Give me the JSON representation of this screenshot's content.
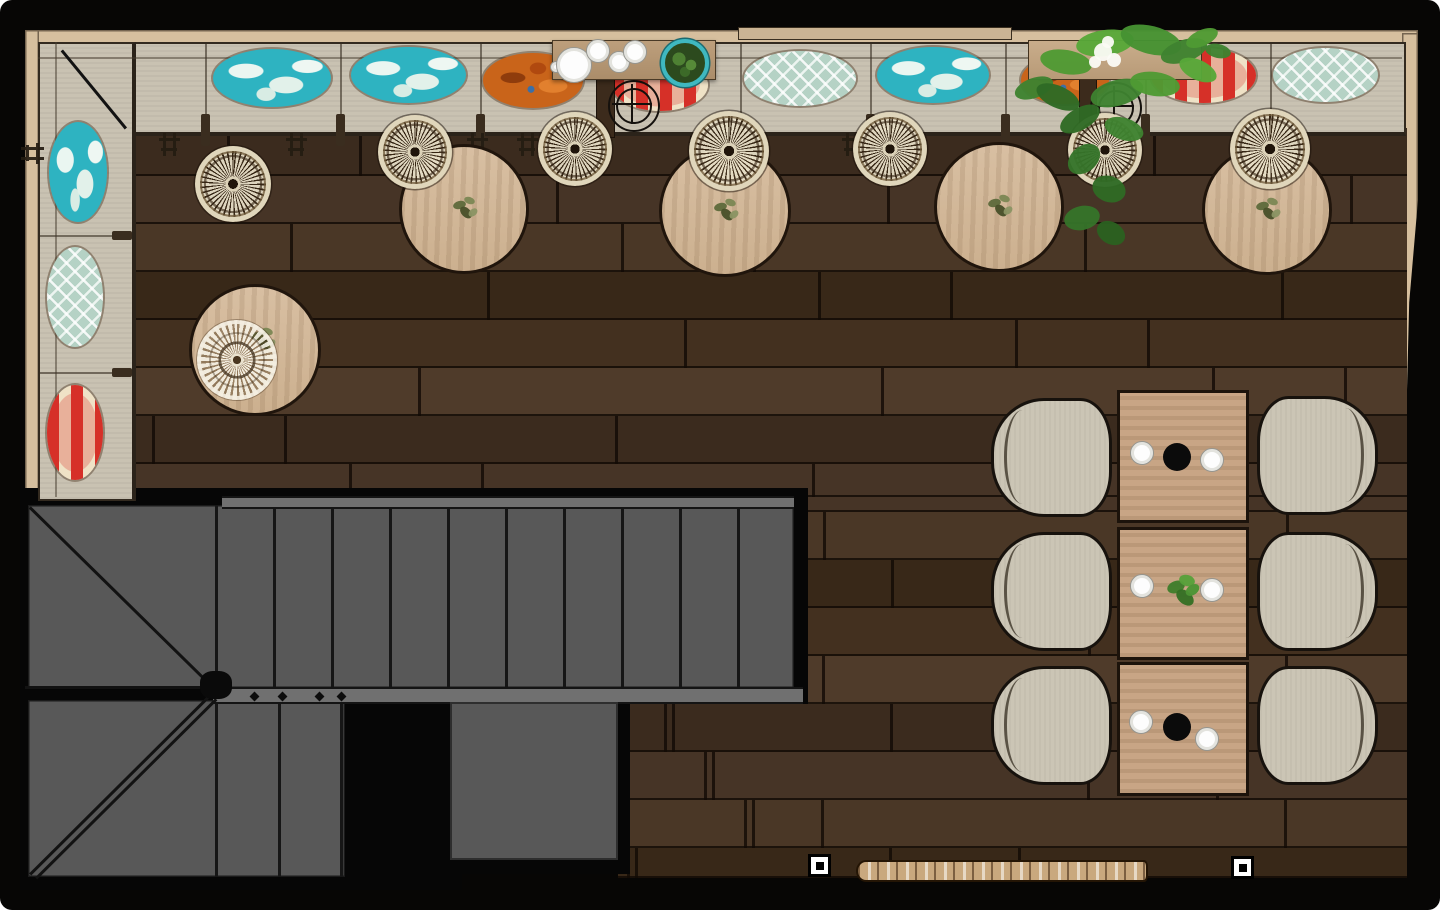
{
  "colors": {
    "wall_black": "#070605",
    "wood_trim": "#d6bf9e",
    "bench_fill": "#c9c2b2",
    "floor_planks": [
      "#463426",
      "#3b2b1e",
      "#4f3b2a",
      "#43301f",
      "#382818",
      "#4a3726"
    ],
    "stair_gray": "#585858",
    "table_wood": "#d3b698",
    "dining_table_wood": "#c8a585",
    "chair_fill": "#cbc5b5",
    "pillow_turquoise": "#2eb3c1",
    "pillow_seafoam": "#b5d2c5",
    "pillow_orange": "#c9641a",
    "pillow_red": "#d63028",
    "plant_green": "#3e8230",
    "pot_teal": "#3fb8c0"
  },
  "structure": {
    "trims": [
      {
        "x": 27,
        "y": 30,
        "w": 1391,
        "h": 16,
        "kind": "trim"
      },
      {
        "x": 25,
        "y": 30,
        "w": 14,
        "h": 462,
        "kind": "trim"
      },
      {
        "x": 1402,
        "y": 33,
        "w": 16,
        "h": 460,
        "kind": "trim"
      },
      {
        "x": 738,
        "y": 27,
        "w": 272,
        "h": 11,
        "kind": "ledge"
      }
    ],
    "right_wall_shadow": {
      "x": 1402,
      "y": 200,
      "w": 16,
      "h": 293
    }
  },
  "floor": {
    "origin_y": 128,
    "row_h": 48,
    "rects": [
      {
        "x": 130,
        "y": 128,
        "w": 1277,
        "h": 369
      },
      {
        "x": 795,
        "y": 497,
        "w": 612,
        "h": 381
      },
      {
        "x": 618,
        "y": 700,
        "w": 177,
        "h": 178
      }
    ]
  },
  "stairs": {
    "blacks": [
      {
        "x": 20,
        "y": 488,
        "w": 788,
        "h": 216
      },
      {
        "x": 20,
        "y": 700,
        "w": 442,
        "h": 190
      },
      {
        "x": 438,
        "y": 690,
        "w": 192,
        "h": 184
      }
    ],
    "flight_upper": {
      "x": 28,
      "y": 505,
      "w": 766,
      "h": 183,
      "treads_x": [
        215,
        273,
        331,
        389,
        447,
        505,
        563,
        621,
        679,
        737
      ]
    },
    "flight_lower": {
      "x": 28,
      "y": 700,
      "w": 317,
      "h": 177,
      "treads_x": [
        215,
        278,
        340
      ]
    },
    "rails": [
      {
        "x": 222,
        "y": 496,
        "w": 572,
        "h": 9
      },
      {
        "x": 213,
        "y": 687,
        "w": 590,
        "h": 13
      }
    ],
    "winder_divider": {
      "x": 25,
      "y": 686,
      "w": 190
    },
    "diagonals": [
      {
        "x1": 30,
        "y1": 507,
        "x2": 212,
        "y2": 686
      },
      {
        "x1": 30,
        "y1": 874,
        "x2": 210,
        "y2": 695
      },
      {
        "x1": 36,
        "y1": 878,
        "x2": 216,
        "y2": 699
      }
    ],
    "platform": {
      "x": 450,
      "y": 702,
      "w": 168,
      "h": 158
    },
    "newel": {
      "x": 200,
      "y": 671,
      "w": 32,
      "h": 28
    },
    "diamonds": [
      [
        251,
        693
      ],
      [
        279,
        693
      ],
      [
        316,
        693
      ],
      [
        338,
        693
      ]
    ]
  },
  "bench": {
    "top": {
      "x": 38,
      "y": 42,
      "w": 1364,
      "h": 88
    },
    "left": {
      "x": 38,
      "y": 42,
      "w": 92,
      "h": 455
    },
    "dividers_x": [
      205,
      340,
      480,
      610,
      740,
      870,
      1005,
      1145,
      1270
    ],
    "dividers_y": [
      235,
      372
    ],
    "corner_seam": {
      "x1": 62,
      "y1": 50,
      "x2": 126,
      "y2": 128
    }
  },
  "bench_marks": [
    {
      "x": 159,
      "y": 131,
      "rot": 0
    },
    {
      "x": 286,
      "y": 131,
      "rot": 0
    },
    {
      "x": 467,
      "y": 131,
      "rot": 0
    },
    {
      "x": 517,
      "y": 131,
      "rot": 0
    },
    {
      "x": 842,
      "y": 131,
      "rot": 0
    },
    {
      "x": 880,
      "y": 131,
      "rot": 0
    },
    {
      "x": 22,
      "y": 140,
      "rot": 90
    }
  ],
  "pillows": [
    {
      "cx": 272,
      "cy": 78,
      "w": 118,
      "h": 58,
      "type": "turquoise"
    },
    {
      "cx": 408,
      "cy": 75,
      "w": 115,
      "h": 56,
      "type": "turquoise"
    },
    {
      "cx": 533,
      "cy": 80,
      "w": 100,
      "h": 55,
      "type": "orange"
    },
    {
      "cx": 660,
      "cy": 85,
      "w": 96,
      "h": 52,
      "type": "redstripe"
    },
    {
      "cx": 800,
      "cy": 78,
      "w": 112,
      "h": 55,
      "type": "seafoam"
    },
    {
      "cx": 933,
      "cy": 75,
      "w": 112,
      "h": 56,
      "type": "turquoise"
    },
    {
      "cx": 1065,
      "cy": 80,
      "w": 88,
      "h": 48,
      "type": "orange"
    },
    {
      "cx": 1203,
      "cy": 75,
      "w": 105,
      "h": 55,
      "type": "redstripe"
    },
    {
      "cx": 1325,
      "cy": 75,
      "w": 105,
      "h": 54,
      "type": "seafoam"
    },
    {
      "cx": 78,
      "cy": 172,
      "w": 58,
      "h": 100,
      "type": "turquoise"
    },
    {
      "cx": 75,
      "cy": 297,
      "w": 56,
      "h": 100,
      "type": "seafoam"
    },
    {
      "cx": 75,
      "cy": 432,
      "w": 56,
      "h": 95,
      "type": "redstripe"
    }
  ],
  "columns": [
    {
      "x": 596,
      "y": 70,
      "w": 17,
      "h": 66
    },
    {
      "x": 1079,
      "y": 70,
      "w": 16,
      "h": 70
    }
  ],
  "column_symbols": [
    {
      "cx": 632,
      "cy": 104,
      "r_outer": 24,
      "r_inner": 16
    },
    {
      "cx": 1114,
      "cy": 106,
      "r_outer": 24,
      "r_inner": 16
    }
  ],
  "round_tables": [
    {
      "cx": 461,
      "cy": 206,
      "r": 62,
      "sprig": true
    },
    {
      "cx": 722,
      "cy": 208,
      "r": 63,
      "sprig": true
    },
    {
      "cx": 996,
      "cy": 204,
      "r": 62,
      "sprig": true
    },
    {
      "cx": 1264,
      "cy": 207,
      "r": 62,
      "sprig": true
    },
    {
      "cx": 252,
      "cy": 347,
      "r": 63,
      "sprig": true,
      "sprig_at": [
        259,
        337
      ]
    }
  ],
  "stools": [
    {
      "cx": 233,
      "cy": 184,
      "r": 38,
      "style": "stool"
    },
    {
      "cx": 415,
      "cy": 152,
      "r": 37,
      "style": "stool"
    },
    {
      "cx": 575,
      "cy": 149,
      "r": 37,
      "style": "stool"
    },
    {
      "cx": 729,
      "cy": 151,
      "r": 40,
      "style": "stool"
    },
    {
      "cx": 890,
      "cy": 149,
      "r": 37,
      "style": "stool"
    },
    {
      "cx": 1105,
      "cy": 150,
      "r": 37,
      "style": "stool"
    },
    {
      "cx": 1270,
      "cy": 149,
      "r": 40,
      "style": "stool"
    },
    {
      "cx": 237,
      "cy": 360,
      "r": 40,
      "style": "doily"
    }
  ],
  "tray": {
    "x": 552,
    "y": 40,
    "w": 162,
    "h": 38,
    "plate": {
      "cx": 573,
      "cy": 64,
      "r": 17
    },
    "plate_handle": {
      "cx": 555,
      "cy": 66,
      "r": 5
    },
    "cups": [
      {
        "cx": 597,
        "cy": 50,
        "r": 11
      },
      {
        "cx": 618,
        "cy": 61,
        "r": 10
      },
      {
        "cx": 634,
        "cy": 51,
        "r": 11
      }
    ],
    "pot": {
      "cx": 681,
      "cy": 59,
      "r": 20
    }
  },
  "planter": {
    "box": {
      "x": 1028,
      "y": 40,
      "w": 172,
      "h": 38
    },
    "leaves": [
      {
        "x": 1014,
        "y": 78,
        "w": 40,
        "h": 20,
        "rot": -20,
        "c": "#3e8230"
      },
      {
        "x": 1040,
        "y": 50,
        "w": 52,
        "h": 24,
        "rot": 10,
        "c": "#4f9a33"
      },
      {
        "x": 1076,
        "y": 30,
        "w": 58,
        "h": 26,
        "rot": -8,
        "c": "#57a838"
      },
      {
        "x": 1120,
        "y": 26,
        "w": 62,
        "h": 28,
        "rot": 14,
        "c": "#469232"
      },
      {
        "x": 1160,
        "y": 40,
        "w": 48,
        "h": 22,
        "rot": -18,
        "c": "#3e8230"
      },
      {
        "x": 1178,
        "y": 60,
        "w": 40,
        "h": 20,
        "rot": 25,
        "c": "#57a838"
      },
      {
        "x": 1035,
        "y": 86,
        "w": 46,
        "h": 22,
        "rot": 24,
        "c": "#2f6a24"
      },
      {
        "x": 1090,
        "y": 80,
        "w": 54,
        "h": 26,
        "rot": -15,
        "c": "#3e8230"
      },
      {
        "x": 1130,
        "y": 72,
        "w": 50,
        "h": 24,
        "rot": 8,
        "c": "#4f9a33"
      },
      {
        "x": 1058,
        "y": 108,
        "w": 44,
        "h": 22,
        "rot": -30,
        "c": "#2f6a24"
      },
      {
        "x": 1104,
        "y": 118,
        "w": 40,
        "h": 22,
        "rot": 18,
        "c": "#3e8230"
      },
      {
        "x": 1066,
        "y": 146,
        "w": 36,
        "h": 26,
        "rot": -40,
        "c": "#35742a"
      },
      {
        "x": 1092,
        "y": 176,
        "w": 34,
        "h": 26,
        "rot": 20,
        "c": "#2f6a24"
      },
      {
        "x": 1064,
        "y": 206,
        "w": 36,
        "h": 24,
        "rot": -12,
        "c": "#35742a"
      },
      {
        "x": 1096,
        "y": 222,
        "w": 30,
        "h": 22,
        "rot": 30,
        "c": "#2b6120"
      },
      {
        "x": 1185,
        "y": 30,
        "w": 34,
        "h": 16,
        "rot": -24,
        "c": "#4f9a33"
      },
      {
        "x": 1205,
        "y": 44,
        "w": 26,
        "h": 14,
        "rot": 12,
        "c": "#3e8230"
      }
    ],
    "flowers": [
      {
        "cx": 1103,
        "cy": 52,
        "r": 9
      },
      {
        "cx": 1114,
        "cy": 60,
        "r": 7
      },
      {
        "cx": 1095,
        "cy": 62,
        "r": 6
      },
      {
        "cx": 1108,
        "cy": 42,
        "r": 6
      }
    ]
  },
  "dining": {
    "tables": [
      {
        "x": 1117,
        "y": 390,
        "w": 126,
        "h": 127,
        "center": "bowl"
      },
      {
        "x": 1117,
        "y": 527,
        "w": 126,
        "h": 127,
        "center": "plant"
      },
      {
        "x": 1117,
        "y": 662,
        "w": 126,
        "h": 128,
        "center": "bowl"
      }
    ],
    "plates": [
      {
        "cx": 1141,
        "cy": 452,
        "r": 11
      },
      {
        "cx": 1211,
        "cy": 459,
        "r": 11
      },
      {
        "cx": 1141,
        "cy": 585,
        "r": 11
      },
      {
        "cx": 1211,
        "cy": 589,
        "r": 11
      },
      {
        "cx": 1140,
        "cy": 721,
        "r": 11
      },
      {
        "cx": 1206,
        "cy": 738,
        "r": 11
      }
    ],
    "bowls": [
      {
        "cx": 1177,
        "cy": 457,
        "r": 14
      },
      {
        "cx": 1177,
        "cy": 727,
        "r": 14
      }
    ],
    "center_plant": {
      "cx": 1177,
      "cy": 587
    },
    "chairs": [
      {
        "cx": 1048,
        "cy": 454,
        "side": "left"
      },
      {
        "cx": 1048,
        "cy": 588,
        "side": "left"
      },
      {
        "cx": 1048,
        "cy": 722,
        "side": "left"
      },
      {
        "cx": 1314,
        "cy": 452,
        "side": "right"
      },
      {
        "cx": 1314,
        "cy": 588,
        "side": "right"
      },
      {
        "cx": 1314,
        "cy": 722,
        "side": "right"
      }
    ],
    "chair_size": {
      "w": 115,
      "h": 113
    }
  },
  "shelf": {
    "x": 856,
    "y": 860,
    "w": 288,
    "h": 18
  },
  "markers": [
    {
      "x": 808,
      "y": 854,
      "s": 23
    },
    {
      "x": 1231,
      "y": 856,
      "s": 23
    }
  ]
}
